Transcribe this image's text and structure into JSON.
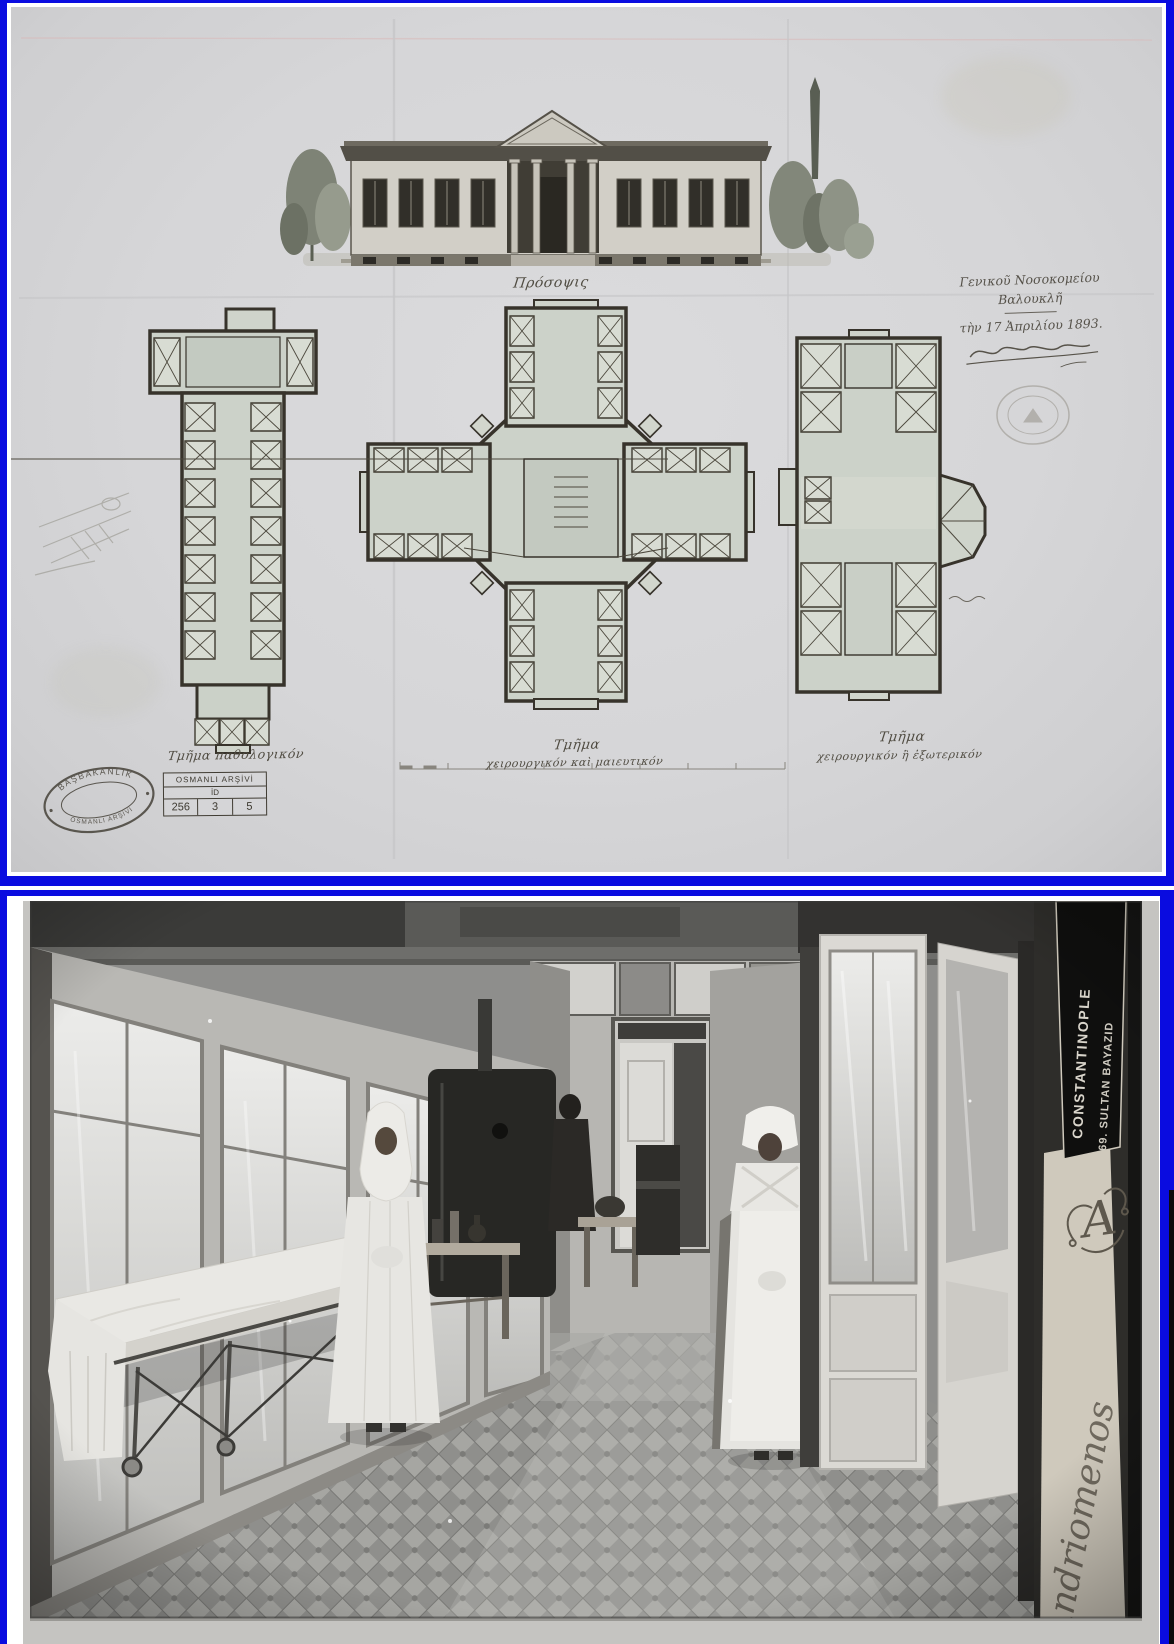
{
  "colors": {
    "frame_blue": "#0a0ce0",
    "paper_gray": "#d6d6d8",
    "ink": "#3f3b31",
    "plan_wash": "#ccd2c9",
    "photo_card": "#cfc9bc"
  },
  "drawing": {
    "elevation_caption": "Πρόσοψις",
    "inscription": {
      "line1": "Γενικοῦ Νοσοκομείου",
      "line2": "Βαλουκλῆ",
      "line3": "τὴν 17 Ἀπριλίου 1893."
    },
    "plans": {
      "left_caption": "Τμῆμα παθολογικόν",
      "center_caption_1": "Τμῆμα",
      "center_caption_2": "χειρουργικόν καὶ μαιευτικόν",
      "right_caption_1": "Τμῆμα",
      "right_caption_2": "χειρουργικόν ἢ ἐξωτερικόν"
    },
    "stamp": {
      "arc_top": "BAŞBAKANLIK",
      "arc_bottom": "OSMANLI ARŞİVİ"
    },
    "archive_table": {
      "header": "OSMANLI ARŞİVİ",
      "sub": "İD",
      "cells": [
        "256",
        "3",
        "5"
      ]
    }
  },
  "photo": {
    "banner_line1": "CONSTANTINOPLE",
    "banner_line2": "69. SULTAN BAYAZID",
    "monogram": "A",
    "signature": "Andriomenos"
  }
}
